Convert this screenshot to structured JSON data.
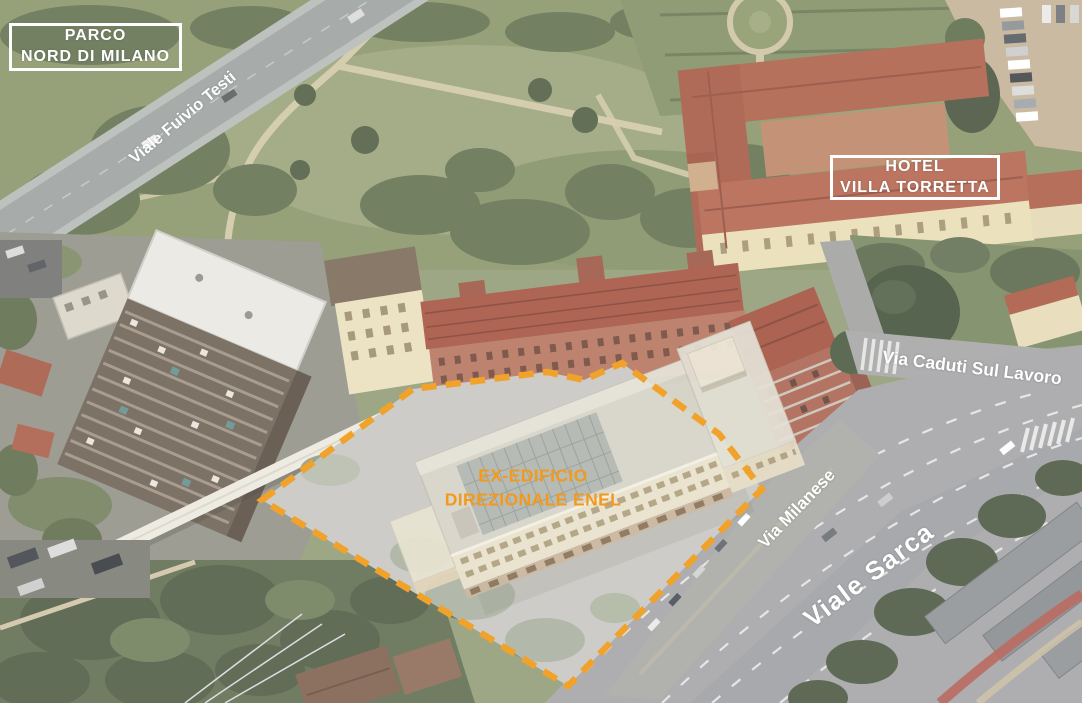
{
  "annotations": {
    "parco_nord_box": {
      "lines": [
        "PARCO",
        "NORD DI MILANO"
      ]
    },
    "hotel_box": {
      "lines": [
        "HOTEL",
        "VILLA TORRETTA"
      ]
    },
    "site_label": {
      "lines": [
        "EX-EDIFICIO",
        "DIREZIONALE ENEL"
      ]
    },
    "street_labels": {
      "viale_fulvio_testi": "Viale Fuivio Testi",
      "via_caduti_sul_lavoro": "Via Caduti Sul Lavoro",
      "via_milanese": "Via Milanese",
      "viale_sarca": "Viale Sarca"
    },
    "colors": {
      "site_outline": "#F0A22A",
      "site_label_text": "#F29A1D",
      "street_label_text": "#FFFFFF"
    }
  }
}
